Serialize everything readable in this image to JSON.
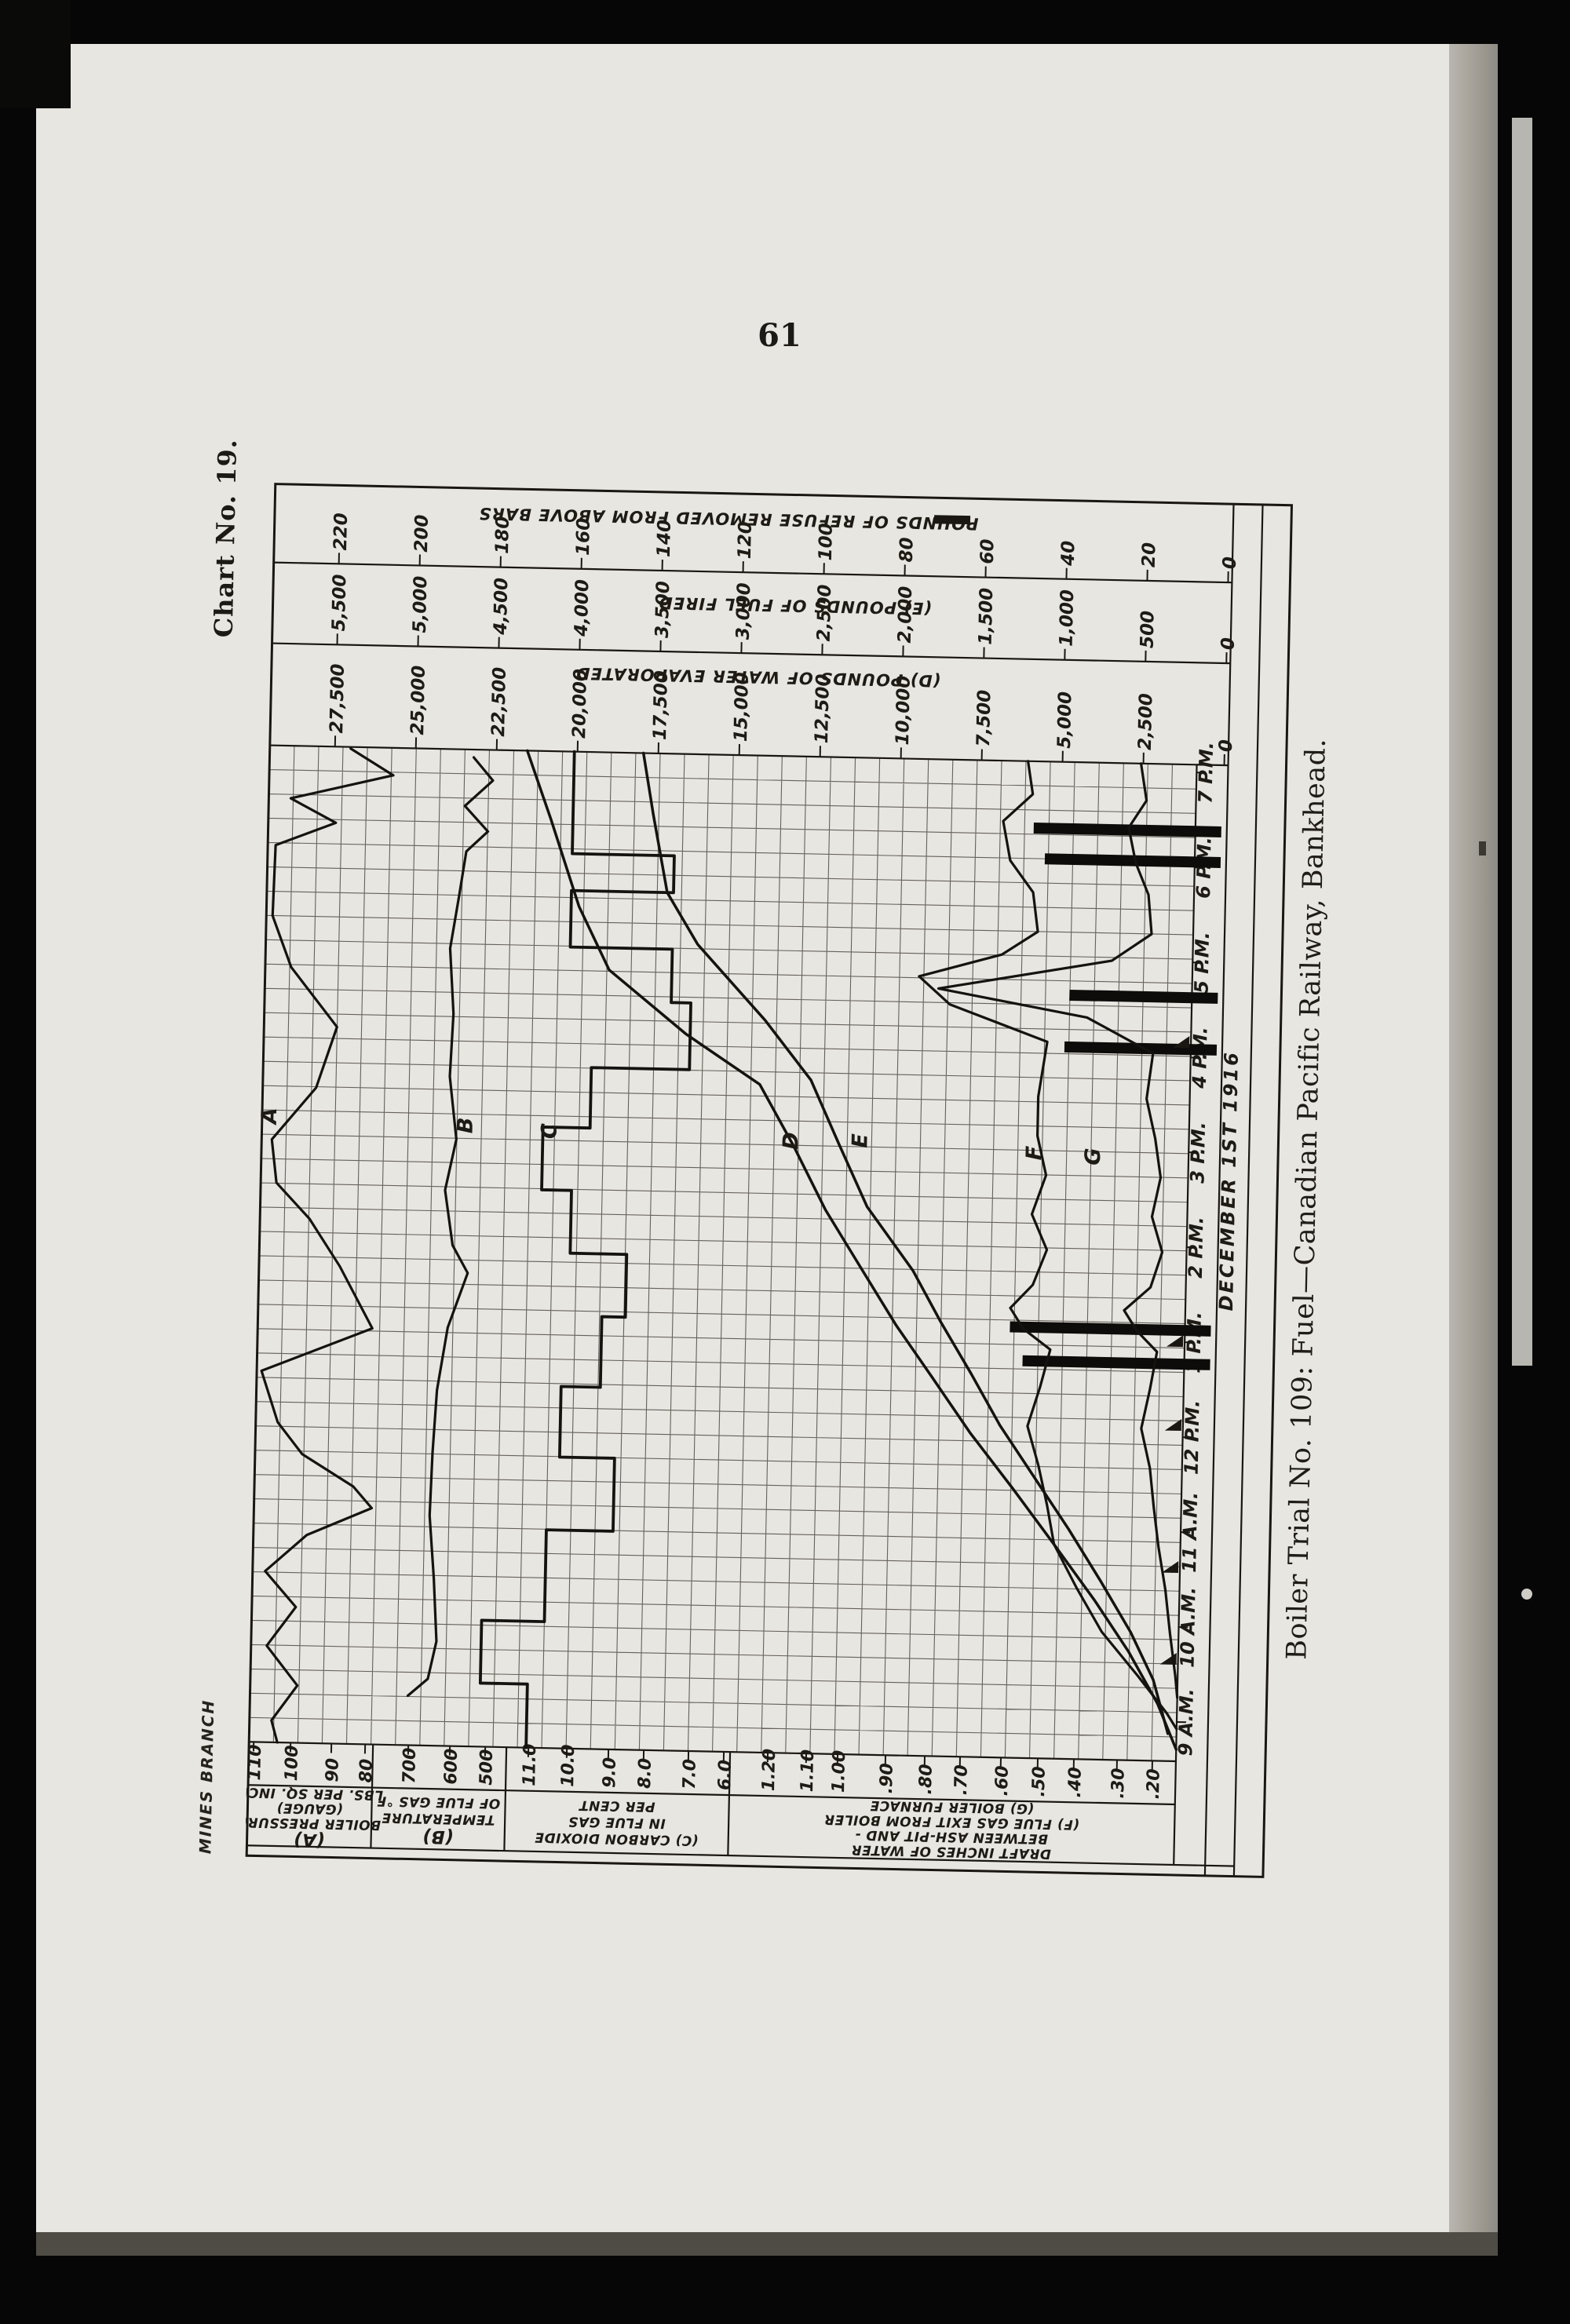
{
  "page": {
    "number": "61",
    "chart_no": "Chart No. 19.",
    "imprint": "MINES BRANCH",
    "caption": "Boiler Trial No. 109: Fuel—Canadian Pacific Railway, Bankhead."
  },
  "chart_data": {
    "type": "line",
    "title": "Chart No. 19 — Boiler Trial No. 109, December 1st 1916",
    "orientation": "chart printed rotated 90° (time axis runs bottom-to-top on the page)",
    "grid": "on",
    "time_axis": {
      "labels": [
        "9 A.M.",
        "10 A.M.",
        "11 A.M.",
        "12 P.M.",
        "1 P.M.",
        "2 P.M.",
        "3 P.M.",
        "4 P.M.",
        "5 P.M.",
        "6 P.M.",
        "7 P.M."
      ],
      "date_label": "DECEMBER 1ST 1916",
      "y_start": 1563,
      "y_step": -121
    },
    "top_scales": [
      {
        "id": "refuse",
        "title": "POUNDS OF REFUSE REMOVED FROM ABOVE BARS",
        "has_bar_glyph": true,
        "title_pos": [
          580,
          49
        ],
        "ticks": [
          "220",
          "200",
          "180",
          "160",
          "140",
          "120",
          "100",
          "80",
          "60",
          "40",
          "20",
          "0"
        ],
        "row_bottom": 110
      },
      {
        "id": "E",
        "title": "(E) POUNDS OF FUEL FIRED",
        "has_bar_glyph": false,
        "title_pos": [
          667,
          158
        ],
        "ticks": [
          "5,500",
          "5,000",
          "4,500",
          "4,000",
          "3,500",
          "3,000",
          "2,500",
          "2,000",
          "1,500",
          "1,000",
          "500",
          "0"
        ],
        "row_bottom": 213
      },
      {
        "id": "D",
        "title": "(D) POUNDS OF WATER EVAPORATED",
        "has_bar_glyph": false,
        "title_pos": [
          622,
          250
        ],
        "ticks": [
          "27,500",
          "25,000",
          "22,500",
          "20,000",
          "17,500",
          "15,000",
          "12,500",
          "10,000",
          "7,500",
          "5,000",
          "2,500",
          "0"
        ],
        "row_bottom": 343
      }
    ],
    "bottom_scales": [
      {
        "id": "A",
        "x0": 2,
        "x1": 160,
        "ticks": [
          "110",
          "100",
          "90",
          "80"
        ],
        "tick_x": [
          8,
          55,
          107,
          150
        ],
        "big_first": true,
        "label_lines": [
          "(A)",
          "BOILER PRESSURE",
          "(GAUGE)",
          "LBS. PER SQ. INCH"
        ]
      },
      {
        "id": "B",
        "x0": 160,
        "x1": 330,
        "ticks": [
          "700",
          "600",
          "500"
        ],
        "tick_x": [
          205,
          258,
          303
        ],
        "big_first": true,
        "label_lines": [
          "(B)",
          "TEMPERATURE",
          "OF FLUE GAS °F"
        ]
      },
      {
        "id": "C",
        "x0": 330,
        "x1": 615,
        "ticks": [
          "11.0",
          "10.0",
          "9.0",
          "8.0",
          "7.0",
          "6.0"
        ],
        "tick_x": [
          358,
          407,
          460,
          505,
          562,
          607
        ],
        "big_first": false,
        "label_lines": [
          "(C) CARBON DIOXIDE",
          "IN FLUE GAS",
          "PER CENT"
        ]
      },
      {
        "id": "FG",
        "x0": 615,
        "x1": 1183,
        "ticks": [
          "1.20",
          "1.10",
          "1.00",
          ".90",
          ".80",
          ".70",
          ".60",
          ".50",
          ".40",
          ".30",
          ".20"
        ],
        "tick_x": [
          663,
          712,
          752,
          813,
          863,
          908,
          960,
          1007,
          1053,
          1108,
          1153
        ],
        "big_first": false,
        "label_lines": [
          "DRAFT INCHES OF WATER",
          "BETWEEN ASH-PIT AND -",
          "(F) FLUE GAS EXIT FROM BOILER",
          "(G) BOILER FURNACE"
        ]
      }
    ],
    "series": [
      {
        "id": "A",
        "name": "Boiler pressure (gauge)",
        "unit": "lbs per sq inch",
        "letter_pos": [
          20,
          815
        ],
        "width": 3.2,
        "values": [
          104,
          99,
          86,
          104,
          79,
          98,
          107,
          93,
          105,
          108,
          84
        ],
        "path": [
          [
            105,
            345
          ],
          [
            160,
            378
          ],
          [
            30,
            410
          ],
          [
            88,
            440
          ],
          [
            12,
            470
          ],
          [
            10,
            560
          ],
          [
            35,
            625
          ],
          [
            95,
            700
          ],
          [
            70,
            778
          ],
          [
            15,
            845
          ],
          [
            22,
            900
          ],
          [
            65,
            945
          ],
          [
            105,
            1005
          ],
          [
            148,
            1083
          ],
          [
            8,
            1140
          ],
          [
            30,
            1205
          ],
          [
            62,
            1245
          ],
          [
            128,
            1285
          ],
          [
            152,
            1312
          ],
          [
            70,
            1348
          ],
          [
            18,
            1395
          ],
          [
            58,
            1440
          ],
          [
            22,
            1490
          ],
          [
            62,
            1540
          ],
          [
            30,
            1585
          ],
          [
            38,
            1613
          ]
        ]
      },
      {
        "id": "B",
        "name": "Temperature of flue gas",
        "unit": "°F",
        "letter_pos": [
          270,
          822
        ],
        "width": 3.2,
        "values": [
          658,
          655,
          660,
          650,
          640,
          615,
          635,
          636,
          629,
          582,
          596
        ],
        "path": [
          [
            262,
            353
          ],
          [
            287,
            382
          ],
          [
            252,
            415
          ],
          [
            282,
            447
          ],
          [
            255,
            473
          ],
          [
            247,
            530
          ],
          [
            237,
            597
          ],
          [
            243,
            680
          ],
          [
            240,
            760
          ],
          [
            250,
            840
          ],
          [
            237,
            905
          ],
          [
            248,
            975
          ],
          [
            268,
            1010
          ],
          [
            244,
            1080
          ],
          [
            232,
            1160
          ],
          [
            228,
            1240
          ],
          [
            226,
            1320
          ],
          [
            233,
            1400
          ],
          [
            238,
            1480
          ],
          [
            228,
            1528
          ],
          [
            203,
            1550
          ]
        ]
      },
      {
        "id": "C",
        "name": "Carbon dioxide in flue gas",
        "unit": "per cent",
        "letter_pos": [
          377,
          827
        ],
        "width": 3.8,
        "values": [
          11.0,
          10.7,
          10.1,
          9.3,
          8.7,
          10.2,
          11.0,
          8.5,
          7.7,
          10.4,
          10.4
        ],
        "path": [
          [
            390,
            343
          ],
          [
            390,
            473
          ],
          [
            520,
            473
          ],
          [
            520,
            520
          ],
          [
            390,
            520
          ],
          [
            390,
            592
          ],
          [
            520,
            592
          ],
          [
            520,
            660
          ],
          [
            545,
            660
          ],
          [
            545,
            745
          ],
          [
            420,
            745
          ],
          [
            420,
            822
          ],
          [
            360,
            822
          ],
          [
            360,
            902
          ],
          [
            398,
            902
          ],
          [
            398,
            982
          ],
          [
            470,
            982
          ],
          [
            470,
            1062
          ],
          [
            440,
            1062
          ],
          [
            440,
            1152
          ],
          [
            390,
            1152
          ],
          [
            390,
            1242
          ],
          [
            460,
            1242
          ],
          [
            460,
            1335
          ],
          [
            375,
            1335
          ],
          [
            375,
            1452
          ],
          [
            295,
            1452
          ],
          [
            295,
            1532
          ],
          [
            355,
            1532
          ],
          [
            355,
            1613
          ]
        ]
      },
      {
        "id": "D",
        "name": "Pounds of water evaporated (cumulative)",
        "unit": "lbs",
        "letter_pos": [
          685,
          833
        ],
        "width": 3.5,
        "values": [
          800,
          2400,
          5700,
          7400,
          9500,
          11500,
          13000,
          15000,
          19400,
          20500,
          21500
        ],
        "path": [
          [
            330,
            343
          ],
          [
            362,
            430
          ],
          [
            400,
            540
          ],
          [
            440,
            620
          ],
          [
            540,
            700
          ],
          [
            635,
            762
          ],
          [
            680,
            840
          ],
          [
            722,
            920
          ],
          [
            770,
            995
          ],
          [
            815,
            1065
          ],
          [
            862,
            1130
          ],
          [
            912,
            1200
          ],
          [
            968,
            1270
          ],
          [
            1022,
            1340
          ],
          [
            1075,
            1410
          ],
          [
            1120,
            1475
          ],
          [
            1158,
            1540
          ],
          [
            1183,
            1598
          ]
        ]
      },
      {
        "id": "E",
        "name": "Pounds of fuel fired (cumulative)",
        "unit": "lbs",
        "letter_pos": [
          773,
          831
        ],
        "width": 3.5,
        "values": [
          240,
          550,
          850,
          1280,
          1640,
          2030,
          2300,
          2810,
          3270,
          3490,
          3590
        ],
        "path": [
          [
            478,
            343
          ],
          [
            492,
            420
          ],
          [
            512,
            520
          ],
          [
            552,
            585
          ],
          [
            640,
            680
          ],
          [
            700,
            755
          ],
          [
            737,
            835
          ],
          [
            775,
            915
          ],
          [
            835,
            995
          ],
          [
            872,
            1060
          ],
          [
            912,
            1125
          ],
          [
            950,
            1190
          ],
          [
            995,
            1255
          ],
          [
            1040,
            1320
          ],
          [
            1082,
            1385
          ],
          [
            1122,
            1450
          ],
          [
            1152,
            1510
          ],
          [
            1172,
            1578
          ]
        ]
      },
      {
        "id": "F",
        "name": "Draft, ash-pit to flue-gas exit from boiler",
        "unit": "inches of water",
        "letter_pos": [
          995,
          842
        ],
        "width": 3.2,
        "values": [
          0.21,
          0.34,
          0.51,
          0.54,
          0.53,
          0.54,
          0.53,
          0.6,
          0.55,
          0.62,
          0.58
        ],
        "path": [
          [
            968,
            343
          ],
          [
            975,
            385
          ],
          [
            938,
            420
          ],
          [
            948,
            470
          ],
          [
            978,
            510
          ],
          [
            985,
            560
          ],
          [
            940,
            590
          ],
          [
            835,
            620
          ],
          [
            875,
            655
          ],
          [
            1000,
            700
          ],
          [
            990,
            770
          ],
          [
            990,
            820
          ],
          [
            1002,
            870
          ],
          [
            985,
            920
          ],
          [
            1005,
            965
          ],
          [
            988,
            1010
          ],
          [
            960,
            1040
          ],
          [
            977,
            1066
          ],
          [
            1012,
            1092
          ],
          [
            1000,
            1140
          ],
          [
            985,
            1190
          ],
          [
            1000,
            1240
          ],
          [
            1012,
            1290
          ],
          [
            1022,
            1340
          ],
          [
            1052,
            1395
          ],
          [
            1085,
            1450
          ],
          [
            1132,
            1505
          ],
          [
            1170,
            1552
          ],
          [
            1183,
            1572
          ]
        ]
      },
      {
        "id": "G",
        "name": "Draft, ash-pit to boiler furnace",
        "unit": "inches of water",
        "letter_pos": [
          1070,
          845
        ],
        "width": 3.2,
        "values": [
          0.2,
          0.25,
          0.3,
          0.33,
          0.32,
          0.33,
          0.32,
          0.37,
          0.34,
          0.4,
          0.38
        ],
        "path": [
          [
            1112,
            343
          ],
          [
            1120,
            390
          ],
          [
            1098,
            425
          ],
          [
            1108,
            470
          ],
          [
            1125,
            510
          ],
          [
            1130,
            560
          ],
          [
            1080,
            595
          ],
          [
            860,
            635
          ],
          [
            1050,
            668
          ],
          [
            1135,
            712
          ],
          [
            1128,
            770
          ],
          [
            1140,
            820
          ],
          [
            1148,
            870
          ],
          [
            1138,
            920
          ],
          [
            1152,
            965
          ],
          [
            1138,
            1010
          ],
          [
            1105,
            1040
          ],
          [
            1122,
            1066
          ],
          [
            1148,
            1092
          ],
          [
            1140,
            1140
          ],
          [
            1130,
            1190
          ],
          [
            1142,
            1240
          ],
          [
            1148,
            1290
          ],
          [
            1155,
            1340
          ],
          [
            1165,
            1395
          ],
          [
            1172,
            1450
          ],
          [
            1180,
            1505
          ],
          [
            1183,
            1532
          ]
        ]
      }
    ],
    "refuse_bars": [
      {
        "time": "6:25 P.M.",
        "lbs": 47,
        "y": 428,
        "x": 977
      },
      {
        "time": "6:05 P.M.",
        "lbs": 44,
        "y": 467,
        "x": 992
      },
      {
        "time": "4:35 P.M.",
        "lbs": 37,
        "y": 640,
        "x": 1027
      },
      {
        "time": "4:15 P.M.",
        "lbs": 38,
        "y": 706,
        "x": 1022
      },
      {
        "time": "1:15 P.M.",
        "lbs": 50,
        "y": 1064,
        "x": 960
      },
      {
        "time": "12:55 P.M.",
        "lbs": 47,
        "y": 1107,
        "x": 977
      }
    ],
    "firing_marks_y": [
      704,
      1085,
      1192,
      1373,
      1490
    ]
  }
}
